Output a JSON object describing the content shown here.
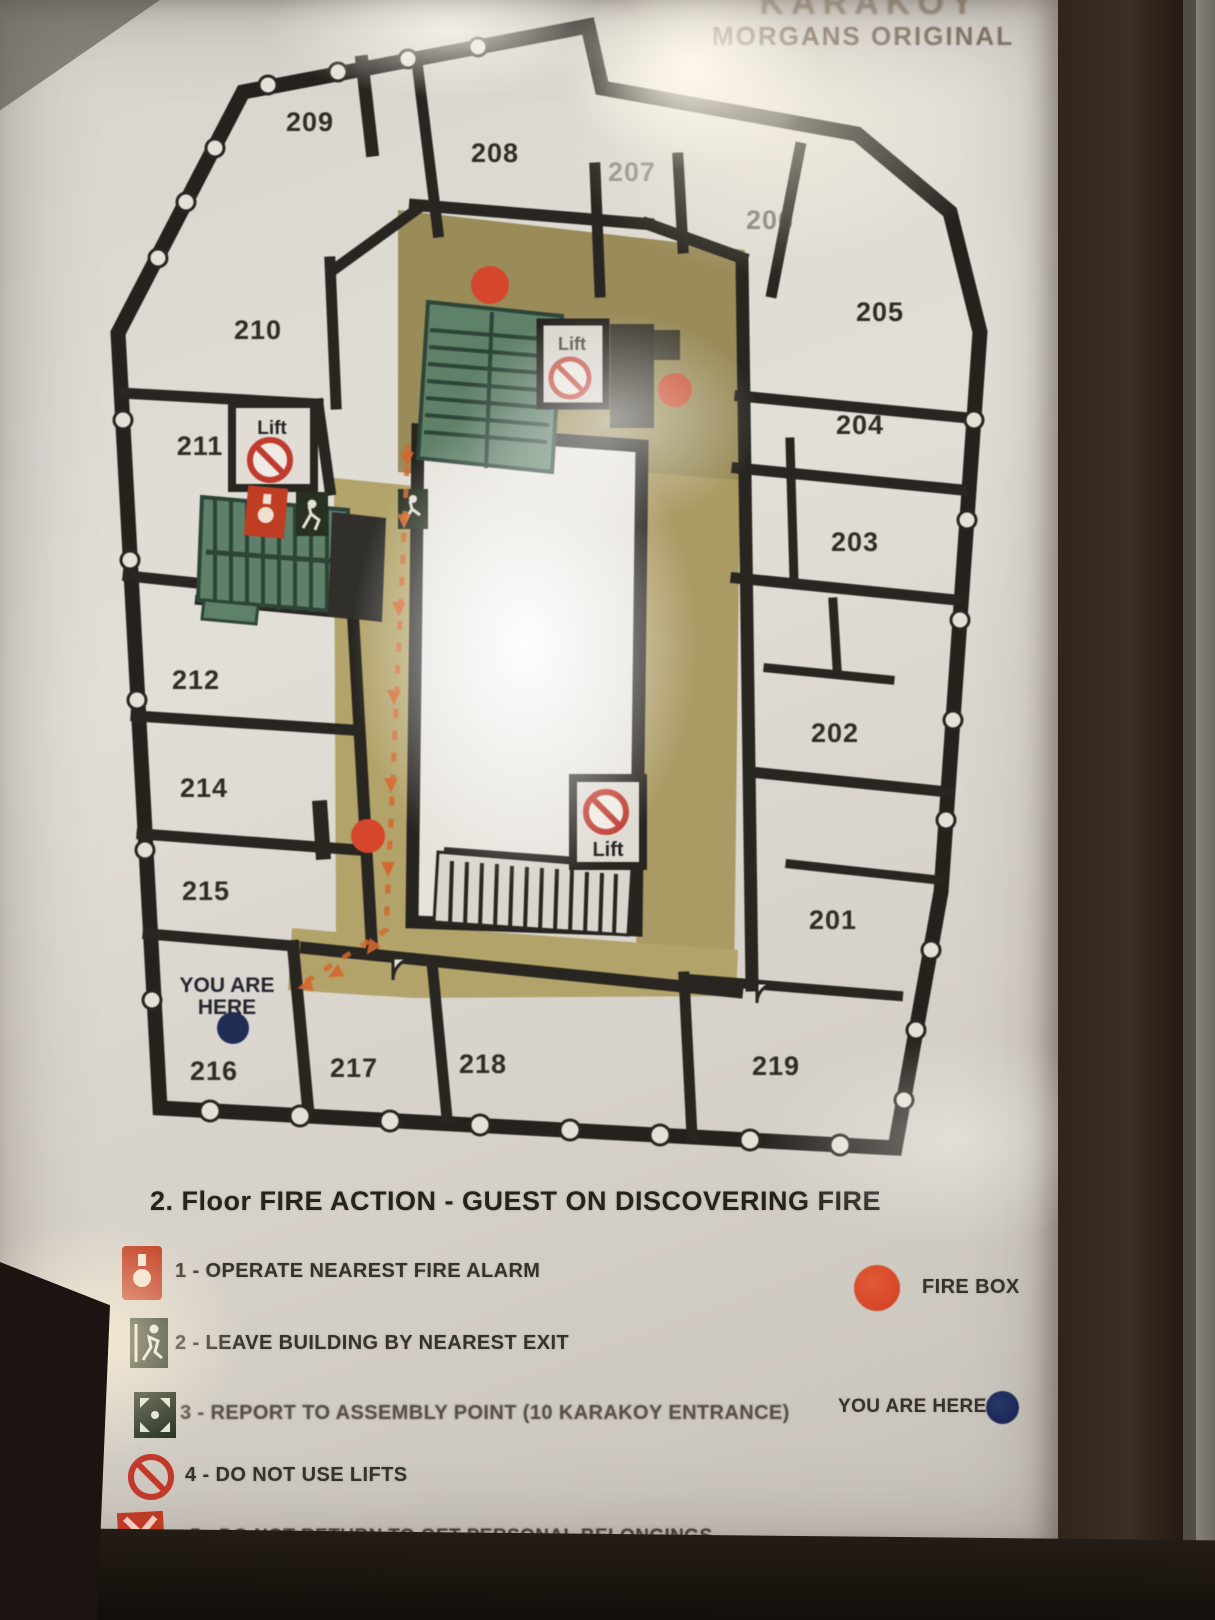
{
  "header": {
    "line1": "KARAKOY",
    "line2": "MORGANS ORIGINAL"
  },
  "floor_plan": {
    "rooms": [
      "209",
      "208",
      "207",
      "206",
      "205",
      "204",
      "203",
      "202",
      "201",
      "210",
      "211",
      "212",
      "214",
      "215",
      "216",
      "217",
      "218",
      "219"
    ],
    "lift_label": "Lift",
    "you_are_here": {
      "line1": "YOU ARE",
      "line2": "HERE"
    }
  },
  "legend": {
    "title": "2. Floor  FIRE ACTION - GUEST ON DISCOVERING FIRE",
    "items": [
      {
        "icon": "fire-alarm-icon",
        "label": "1 - OPERATE NEAREST FIRE ALARM"
      },
      {
        "icon": "exit-running-man-icon",
        "label": "2 - LEAVE BUILDING BY NEAREST EXIT"
      },
      {
        "icon": "assembly-point-icon",
        "label": "3 - REPORT TO ASSEMBLY POINT (10 KARAKOY ENTRANCE)"
      },
      {
        "icon": "no-lifts-icon",
        "label": "4 - DO NOT USE LIFTS"
      },
      {
        "icon": "do-not-return-icon",
        "label": "5 - DO NOT RETURN TO GET PERSONAL BELONGINGS"
      }
    ],
    "fire_box_label": "FIRE BOX",
    "you_are_here_label": "YOU ARE HERE"
  },
  "colors": {
    "fire_box_red": "#d8442a",
    "you_are_here_navy": "#1d2b55",
    "corridor_tan": "#ac9c63",
    "stairs_green": "#5e8068",
    "route_orange": "#d9662b"
  }
}
